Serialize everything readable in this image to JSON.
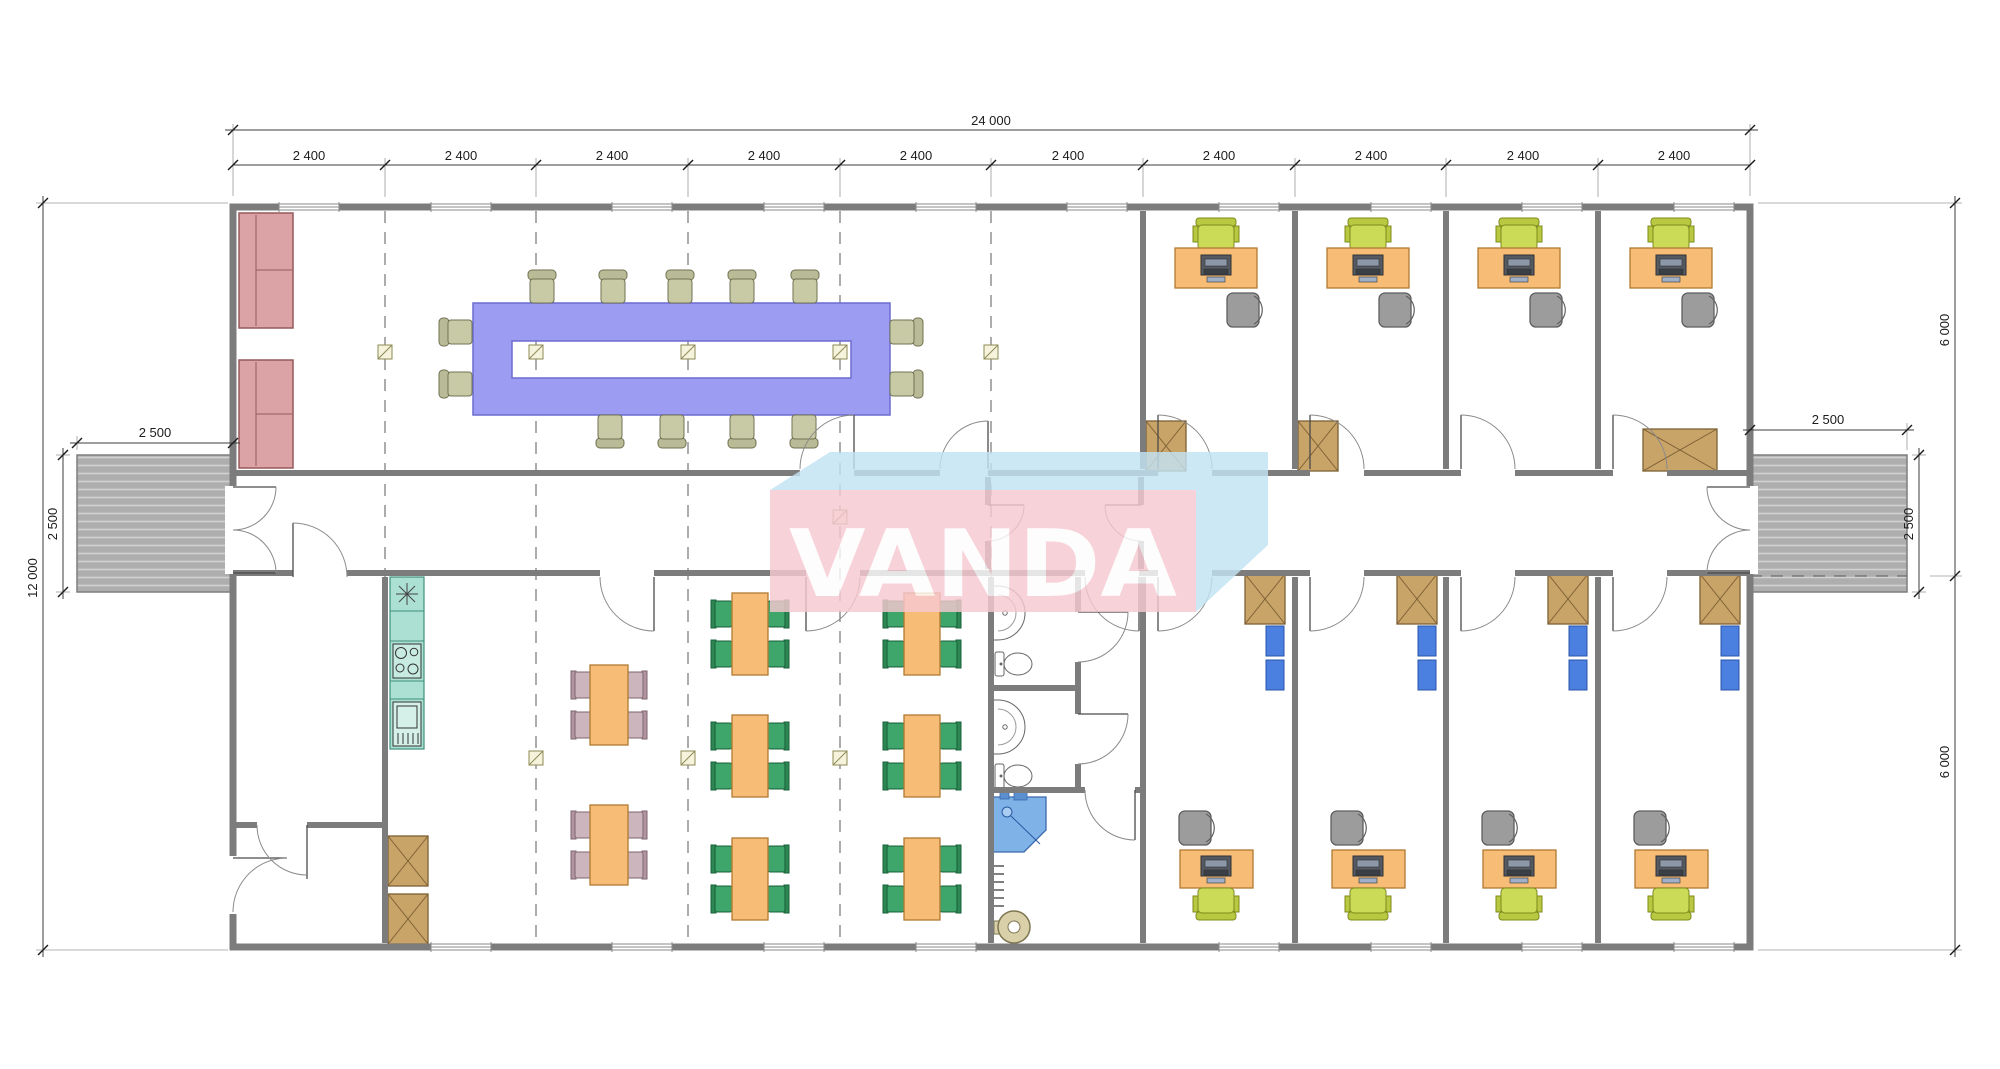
{
  "plan": {
    "watermark": {
      "text": "VANDA",
      "pink": "#f7c9d1",
      "blue": "#c3e3f4"
    },
    "dimensions": {
      "overall_width": "24 000",
      "overall_height": "12 000",
      "modules": [
        "2 400",
        "2 400",
        "2 400",
        "2 400",
        "2 400",
        "2 400",
        "2 400",
        "2 400",
        "2 400",
        "2 400"
      ],
      "right_height_top": "6 000",
      "right_height_bottom": "6 000",
      "porch_left_width": "2 500",
      "porch_left_depth": "2 500",
      "porch_right_width": "2 500",
      "porch_right_depth": "2 500"
    },
    "colors": {
      "wall": "#7c7c7c",
      "conference_table": "#9c9cf2",
      "sofa": "#dba3a6",
      "desk": "#f7bd77",
      "visitor_chair": "#cbdb57",
      "office_chair": "#9c9c9c",
      "canteen_chair": "#3ea56b",
      "kitchen_chair": "#cdb5be",
      "cabinet": "#c9a469",
      "shelf": "#4b7fe0",
      "kitchen_counter": "#abe0d2",
      "shower": "#7fb3e8",
      "porch": "#b0b0b0"
    },
    "legend_icons": [
      "sofa-icon",
      "conference-table-icon",
      "office-desk-icon",
      "computer-icon",
      "office-chair-icon",
      "visitor-chair-icon",
      "cabinet-icon",
      "shelf-icon",
      "dining-table-icon",
      "dining-chair-icon",
      "kitchen-counter-icon",
      "stove-icon",
      "sink-icon",
      "wc-icon",
      "shower-icon",
      "water-heater-icon",
      "radiator-icon",
      "porch-icon",
      "column-marker-icon",
      "door-swing-icon",
      "window-icon"
    ]
  }
}
